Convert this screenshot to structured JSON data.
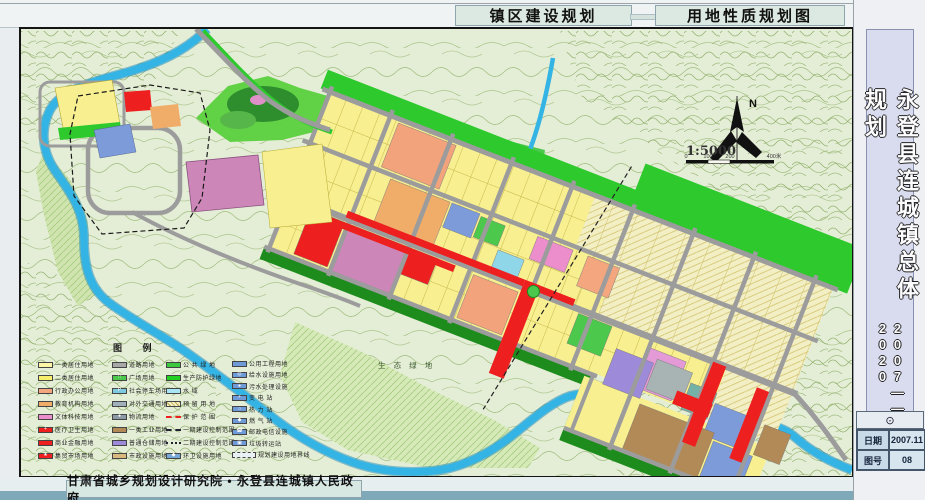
{
  "header": {
    "title_left": "镇区建设规划",
    "title_right": "用地性质规划图"
  },
  "sidebar": {
    "title": "永登县连城镇总体规划",
    "years": "2007——2020"
  },
  "titleblock": {
    "stamp": "⊙",
    "rows": [
      {
        "label": "日期",
        "value": "2007.11"
      },
      {
        "label": "图号",
        "value": "08"
      }
    ]
  },
  "footer": {
    "credit": "甘肃省城乡规划设计研究院 • 永登县连城镇人民政府"
  },
  "map": {
    "north_label": "N",
    "scale_text": "1:5000",
    "scale_ticks": [
      "0",
      "100",
      "200",
      "400米"
    ],
    "eco_label": "生 态 绿 地"
  },
  "palette": {
    "mapbg": "#e4eed6",
    "river": "#34b4e4",
    "riverEdge": "#1b85b5",
    "road": "#9c9c9c",
    "yellow": "#f7ef90",
    "reserve": "#f3efc4",
    "orange1": "#f2a37c",
    "orange2": "#f0ad6a",
    "salmon": "#f4a67e",
    "red": "#ee1f1f",
    "pink1": "#ec8ecb",
    "pink2": "#e39ad6",
    "mauve": "#cd86b8",
    "purple": "#9d8ad9",
    "blue": "#7d9bd8",
    "cyan": "#8fd6e8",
    "teal": "#74b2a8",
    "gray2": "#a8b4b4",
    "brown": "#b28a58",
    "green2": "#2dc92d",
    "green3": "#1d8c1d",
    "park": "#2e8e2e",
    "grass": "#5ad03e",
    "greensq": "#4cc84c",
    "eco": "#d6eab8"
  },
  "legend": {
    "title": "图  例",
    "columns": [
      [
        {
          "label": "一类居住用地",
          "sw": {
            "c": "#fdf6a6"
          }
        },
        {
          "label": "二类居住用地",
          "sw": {
            "c": "#f7ee6c"
          }
        },
        {
          "label": "行政办公用地",
          "sw": {
            "c": "#f4a67e"
          }
        },
        {
          "label": "教育机构用地",
          "sw": {
            "c": "#f0ad6a"
          }
        },
        {
          "label": "文体科技用地",
          "sw": {
            "c": "#ec8ecb"
          }
        },
        {
          "label": "医疗卫生用地",
          "sw": {
            "c": "#ee1f1f",
            "i": "+"
          }
        },
        {
          "label": "商业金融用地",
          "sw": {
            "c": "#ee1f1f"
          }
        },
        {
          "label": "集贸市场用地",
          "sw": {
            "c": "#ee1f1f",
            "i": "★"
          }
        }
      ],
      [
        {
          "label": "道路用地",
          "sw": {
            "c": "#a8a8a8"
          }
        },
        {
          "label": "广场用地",
          "sw": {
            "c": "#4cc84c",
            "i": "∷"
          }
        },
        {
          "label": "社会停车场用地",
          "sw": {
            "c": "#7fc9e0",
            "i": "P"
          }
        },
        {
          "label": "对外交通用地",
          "sw": {
            "c": "#9fb0bb"
          }
        },
        {
          "label": "物流用地",
          "sw": {
            "c": "#8b9aa4",
            "i": "●"
          }
        },
        {
          "label": "一类工业用地",
          "sw": {
            "c": "#b28a58"
          }
        },
        {
          "label": "普通仓储用地",
          "sw": {
            "c": "#9d8ad9"
          }
        },
        {
          "label": "市政设施用地",
          "sw": {
            "c": "#d9b97e"
          }
        }
      ],
      [
        {
          "label": "公 共 绿 地",
          "sw": {
            "c": "#3cc83c"
          }
        },
        {
          "label": "生产防护绿地",
          "sw": {
            "c": "#22d022"
          }
        },
        {
          "label": "水    域",
          "sw": {
            "c": "#a8e6f6"
          }
        },
        {
          "label": "预 留 用 地",
          "sw": {
            "c": "#f3efc4",
            "t": "hatch"
          }
        },
        {
          "label": "保 护 范 围",
          "sw": {
            "t": "line",
            "ls": "dashed",
            "lc": "#ee1f1f"
          }
        },
        {
          "label": "一期建设控制范围",
          "sw": {
            "t": "line",
            "ls": "dashed",
            "lc": "#222233"
          }
        },
        {
          "label": "二期建设控制范围",
          "sw": {
            "t": "line",
            "ls": "dotted",
            "lc": "#222233"
          }
        },
        {
          "label": "环卫设施用地",
          "sw": {
            "c": "#78a8d8",
            "i": "◆"
          }
        }
      ],
      [
        {
          "label": "公用工程用地",
          "sw": {
            "c": "#6f9ad8"
          }
        },
        {
          "label": "给水设施用地",
          "sw": {
            "c": "#6f9ad8",
            "i": "◎"
          }
        },
        {
          "label": "污水处理设施",
          "sw": {
            "c": "#6f9ad8",
            "i": "●"
          }
        },
        {
          "label": "变 电 站",
          "sw": {
            "c": "#6f9ad8",
            "i": "⚡"
          }
        },
        {
          "label": "热 力 站",
          "sw": {
            "c": "#6f9ad8",
            "i": "○"
          }
        },
        {
          "label": "燃 气 站",
          "sw": {
            "c": "#6f9ad8",
            "i": "◆"
          }
        },
        {
          "label": "邮政电信设施",
          "sw": {
            "c": "#6f9ad8",
            "i": "☎"
          }
        },
        {
          "label": "垃圾转运站",
          "sw": {
            "c": "#6f9ad8",
            "i": "▣"
          }
        },
        {
          "label": "规划建设用地界线",
          "sw": {
            "t": "wide",
            "c": "#e8f0f4"
          }
        }
      ]
    ]
  }
}
